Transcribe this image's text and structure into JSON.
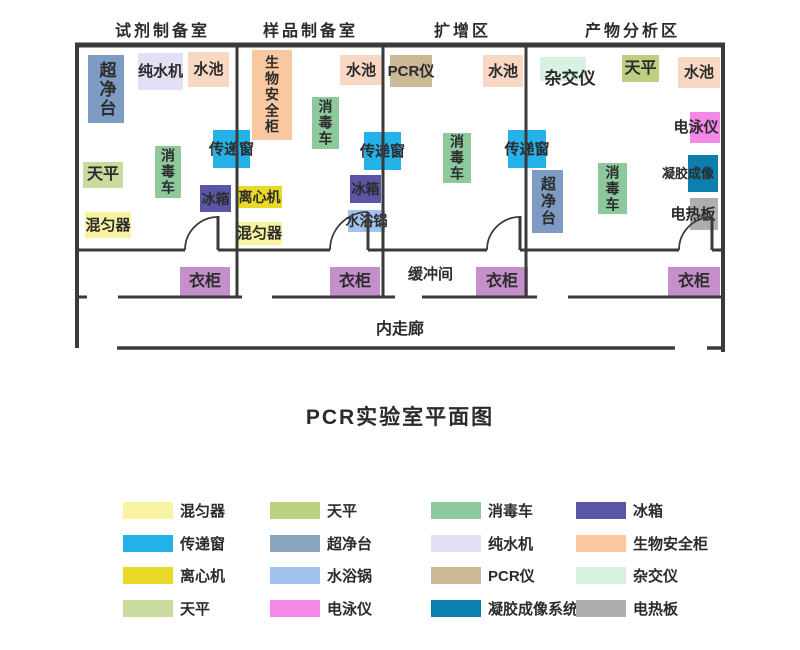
{
  "title": "PCR实验室平面图",
  "plan": {
    "rooms": [
      {
        "label": "试剂制备室"
      },
      {
        "label": "样品制备室"
      },
      {
        "label": "扩增区"
      },
      {
        "label": "产物分析区"
      }
    ],
    "areas": {
      "buffer": "缓冲间",
      "corridor": "内走廊"
    },
    "items": [
      {
        "name": "clean-bench",
        "label": "超净台"
      },
      {
        "name": "water-purifier",
        "label": "纯水机"
      },
      {
        "name": "sink",
        "label": "水池"
      },
      {
        "name": "pass-box",
        "label": "传递窗"
      },
      {
        "name": "disinfection-cart",
        "label": "消毒车"
      },
      {
        "name": "balance",
        "label": "天平"
      },
      {
        "name": "fridge",
        "label": "冰箱"
      },
      {
        "name": "mixer",
        "label": "混匀器"
      },
      {
        "name": "biosafety-cabinet",
        "label": "生物安全柜"
      },
      {
        "name": "sink",
        "label": "水池"
      },
      {
        "name": "disinfection-cart",
        "label": "消毒车"
      },
      {
        "name": "pass-box",
        "label": "传递窗"
      },
      {
        "name": "centrifuge",
        "label": "离心机"
      },
      {
        "name": "mixer",
        "label": "混匀器"
      },
      {
        "name": "fridge",
        "label": "冰箱"
      },
      {
        "name": "water-bath",
        "label": "水浴锅"
      },
      {
        "name": "pcr-machine",
        "label": "PCR仪"
      },
      {
        "name": "sink",
        "label": "水池"
      },
      {
        "name": "disinfection-cart",
        "label": "消毒车"
      },
      {
        "name": "pass-box",
        "label": "传递窗"
      },
      {
        "name": "hybridization-instrument",
        "label": "杂交仪"
      },
      {
        "name": "balance",
        "label": "天平"
      },
      {
        "name": "sink",
        "label": "水池"
      },
      {
        "name": "clean-bench",
        "label": "超净台"
      },
      {
        "name": "disinfection-cart",
        "label": "消毒车"
      },
      {
        "name": "electrophoresis",
        "label": "电泳仪"
      },
      {
        "name": "gel-imaging",
        "label": "凝胶成像"
      },
      {
        "name": "hot-plate",
        "label": "电热板"
      },
      {
        "name": "wardrobe",
        "label": "衣柜"
      },
      {
        "name": "wardrobe",
        "label": "衣柜"
      },
      {
        "name": "wardrobe",
        "label": "衣柜"
      },
      {
        "name": "wardrobe",
        "label": "衣柜"
      }
    ]
  },
  "colors": {
    "clean_bench": "#7e9cc3",
    "water_purifier": "#e3e0f6",
    "sink": "#f8d7c3",
    "pass_box": "#25b2e8",
    "disinfection_cart": "#8ec89d",
    "balance": "#cada9f",
    "balance2": "#bdcf80",
    "fridge": "#5b55a6",
    "mixer": "#f7f3a0",
    "biosafety_cabinet": "#f9c8a0",
    "centrifuge": "#e9d827",
    "water_bath": "#a2c2ee",
    "pcr": "#cbb894",
    "hybridization": "#d7f2e3",
    "electrophoresis": "#f388e8",
    "gel_imaging": "#0d7fae",
    "hot_plate": "#aeaeae",
    "wardrobe": "#c48fca"
  },
  "legend": {
    "items": [
      {
        "label": "混匀器",
        "color": "#f7f3a0"
      },
      {
        "label": "传递窗",
        "color": "#25b2e8"
      },
      {
        "label": "离心机",
        "color": "#e9d827"
      },
      {
        "label": "天平",
        "color": "#cada9f"
      },
      {
        "label": "天平",
        "color": "#bdcf80"
      },
      {
        "label": "超净台",
        "color": "#8aa3c1"
      },
      {
        "label": "水浴锅",
        "color": "#a2c2ee"
      },
      {
        "label": "电泳仪",
        "color": "#f388e8"
      },
      {
        "label": "消毒车",
        "color": "#8ec89d"
      },
      {
        "label": "纯水机",
        "color": "#e3e0f6"
      },
      {
        "label": "PCR仪",
        "color": "#cbb894"
      },
      {
        "label": "凝胶成像系统",
        "color": "#0d7fae"
      },
      {
        "label": "冰箱",
        "color": "#5b55a6"
      },
      {
        "label": "生物安全柜",
        "color": "#f9c8a0"
      },
      {
        "label": "杂交仪",
        "color": "#d7f2e3"
      },
      {
        "label": "电热板",
        "color": "#aeaeae"
      }
    ]
  }
}
